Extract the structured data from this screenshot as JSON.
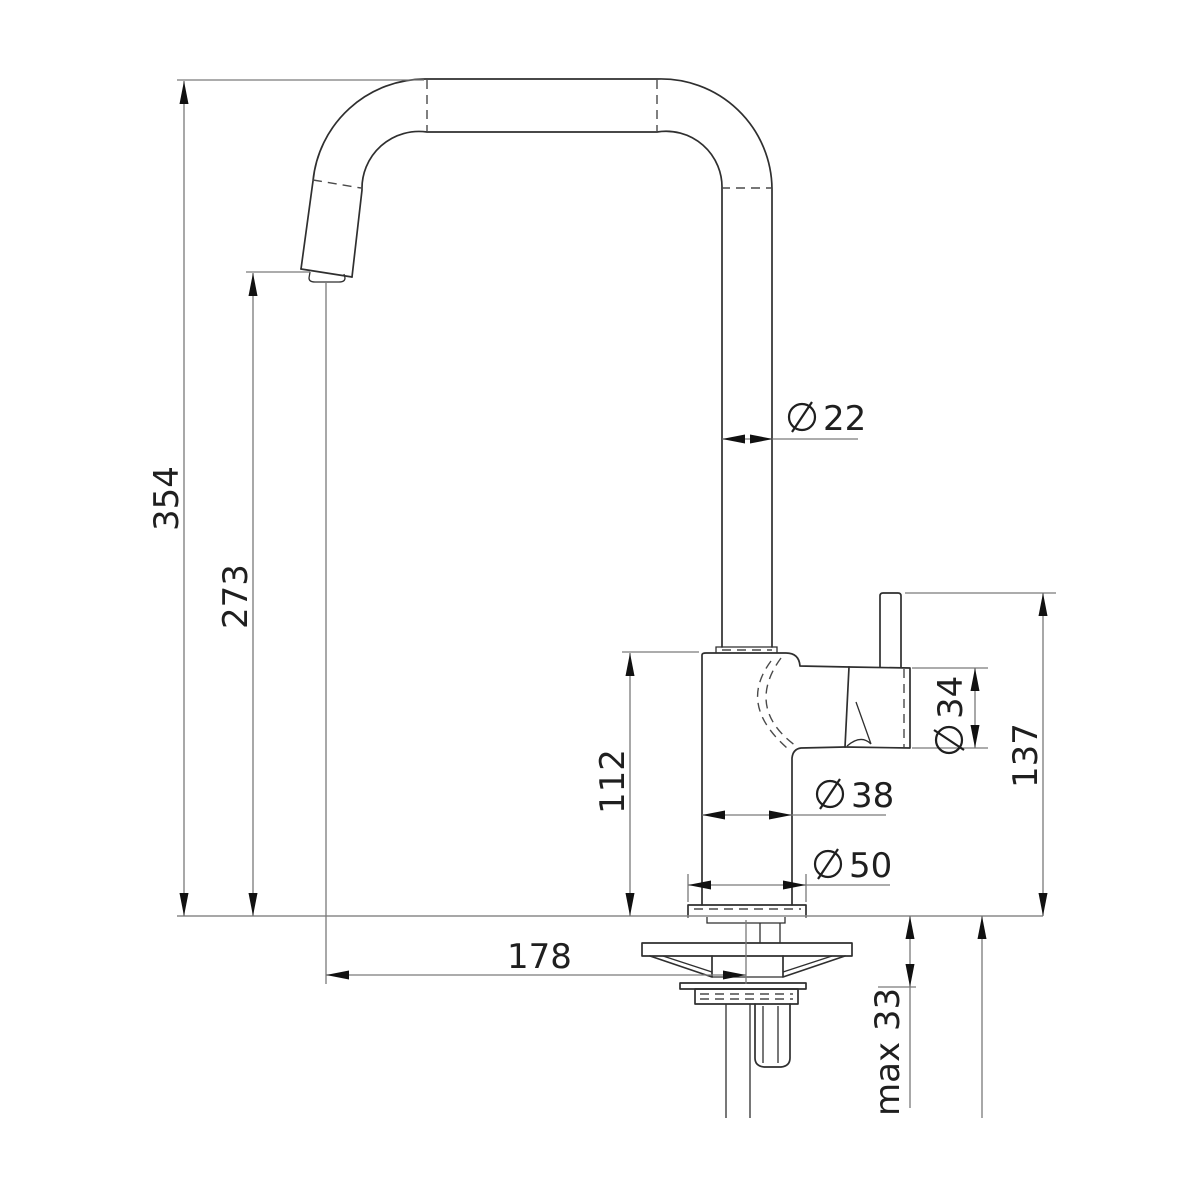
{
  "drawing": {
    "type": "faucet-technical-drawing",
    "colors": {
      "background": "#ffffff",
      "outline": "#2f2f2f",
      "dimension_lines": "#7a7a7a",
      "text": "#1f1f1f"
    },
    "dimensions": {
      "total_height": "354",
      "spout_outlet_height": "273",
      "spout_tube_diameter": "22",
      "body_height": "112",
      "body_diameter": "38",
      "base_diameter": "50",
      "handle_top_height": "137",
      "cartridge_diameter": "34",
      "spout_reach": "178",
      "max_mounting_thickness": "max 33"
    }
  }
}
